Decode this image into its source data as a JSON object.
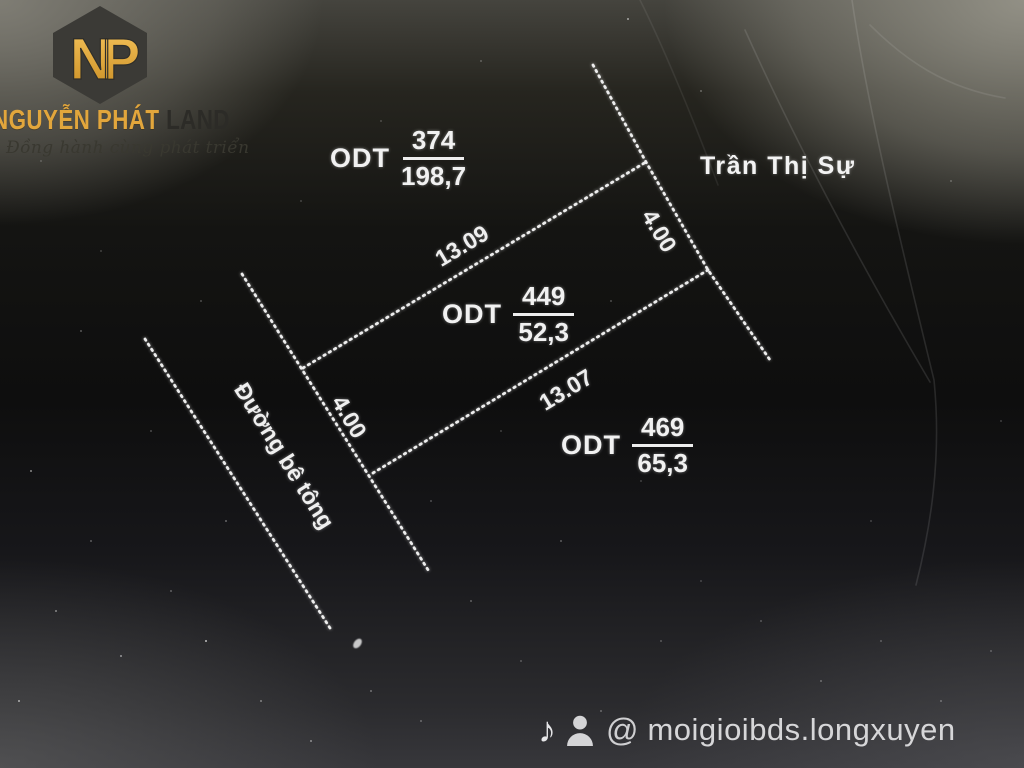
{
  "brand": {
    "monogram": "NP",
    "name_gold": "NGUYỄN PHÁT",
    "name_dark": "LAND",
    "tagline": "Đồng hành cùng phát triển",
    "gold_color": "#e2a63c"
  },
  "map": {
    "neighbor": "Trần Thị Sự",
    "road": "Đường bê tông",
    "parcels": [
      {
        "zone": "ODT",
        "lot": "374",
        "area": "198,7"
      },
      {
        "zone": "ODT",
        "lot": "449",
        "area": "52,3"
      },
      {
        "zone": "ODT",
        "lot": "469",
        "area": "65,3"
      }
    ],
    "dims": {
      "top_edge": "13.09",
      "bottom_edge": "13.07",
      "right_width": "4.00",
      "left_width": "4.00"
    },
    "line_color": "#ededed"
  },
  "footer": {
    "tiktok_glyph": "♪",
    "at_glyph": "@",
    "handle": "moigioibds.longxuyen"
  }
}
